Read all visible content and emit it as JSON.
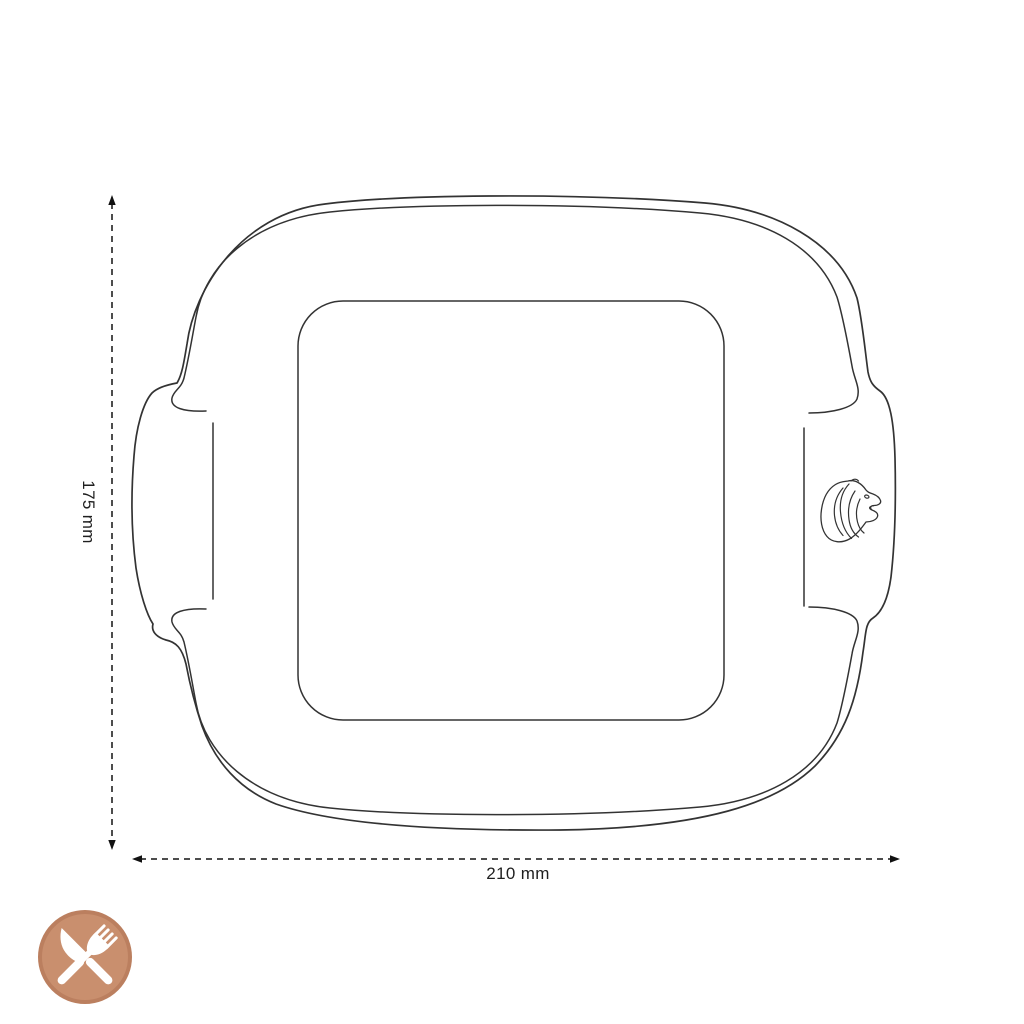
{
  "theme": {
    "background": "#ffffff",
    "line_color": "#333333",
    "dim_line_color": "#4d4d4d",
    "arrow_color": "#111111",
    "label_color": "#1f1f1f"
  },
  "drawing": {
    "subject": "square-oven-dish-top-view-line-drawing",
    "logo_icon": "lion-head"
  },
  "dimensions": {
    "height_label": "175 mm",
    "width_label": "210 mm"
  },
  "badge": {
    "icon": "crossed-knife-and-fork",
    "fill": "#c98f6e",
    "ring": "#bb7f5f",
    "glyph_color": "#ffffff"
  }
}
